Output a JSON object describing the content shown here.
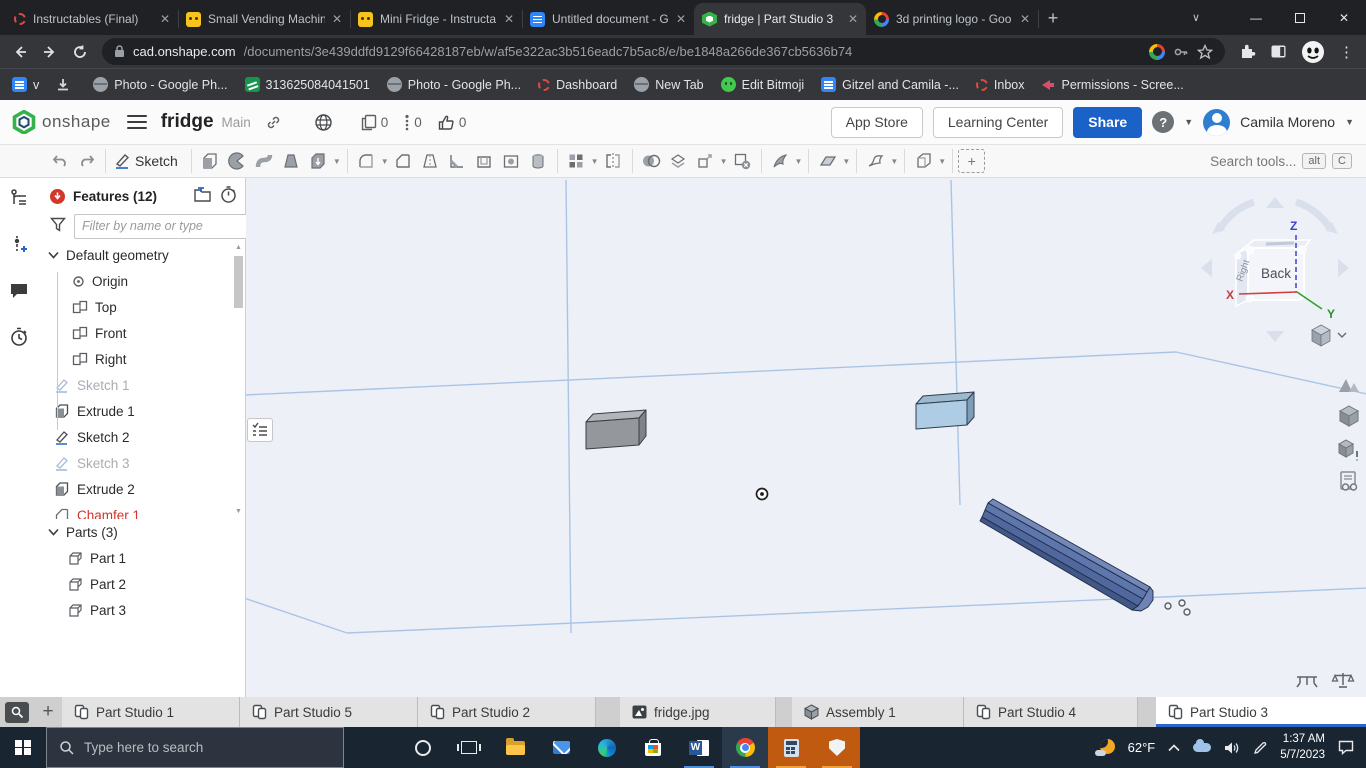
{
  "colors": {
    "accent_blue": "#1b62c8",
    "active_tab_underline": "#2a66c9",
    "error_red": "#d0342b",
    "viewport_bg": "#edf0f6",
    "plane_line": "#aac4e6",
    "part_gray": "#94989c",
    "part_blue_light": "#aecce3",
    "part_blue_bar": "#50689e",
    "taskbar_attention": "#c05a11"
  },
  "browser": {
    "tabs": [
      {
        "title": "Instructables (Final)"
      },
      {
        "title": "Small Vending Machin"
      },
      {
        "title": "Mini Fridge - Instructa"
      },
      {
        "title": "Untitled document - G"
      },
      {
        "title": "fridge | Part Studio 3"
      },
      {
        "title": "3d printing logo - Goo"
      }
    ],
    "nav": {
      "url_domain": "cad.onshape.com",
      "url_path": "/documents/3e439ddfd9129f66428187eb/w/af5e322ac3b516eadc7b5ac8/e/be1848a266de367cb5636b74"
    },
    "bookmarks": [
      {
        "label": "v"
      },
      {
        "label": ""
      },
      {
        "label": "Photo - Google Ph..."
      },
      {
        "label": "313625084041501"
      },
      {
        "label": "Photo - Google Ph..."
      },
      {
        "label": "Dashboard"
      },
      {
        "label": "New Tab"
      },
      {
        "label": "Edit Bitmoji"
      },
      {
        "label": "Gitzel and Camila -..."
      },
      {
        "label": "Inbox"
      },
      {
        "label": "Permissions - Scree..."
      }
    ]
  },
  "onshape": {
    "header": {
      "logo": "onshape",
      "title": "fridge",
      "workspace": "Main",
      "copy_count": "0",
      "version_count": "0",
      "like_count": "0",
      "app_store_label": "App Store",
      "learning_center_label": "Learning Center",
      "share_label": "Share",
      "help_label": "?",
      "user_name": "Camila Moreno"
    },
    "toolbar": {
      "sketch_label": "Sketch",
      "search_text": "Search tools...",
      "shortcut_alt": "alt",
      "shortcut_c": "C"
    },
    "features_panel": {
      "title": "Features (12)",
      "filter_placeholder": "Filter by name or type",
      "tree": [
        {
          "label": "Default geometry"
        },
        {
          "label": "Origin"
        },
        {
          "label": "Top"
        },
        {
          "label": "Front"
        },
        {
          "label": "Right"
        },
        {
          "label": "Sketch 1"
        },
        {
          "label": "Extrude 1"
        },
        {
          "label": "Sketch 2"
        },
        {
          "label": "Sketch 3"
        },
        {
          "label": "Extrude 2"
        },
        {
          "label": "Chamfer 1"
        }
      ],
      "parts_title": "Parts (3)",
      "parts": [
        {
          "label": "Part 1"
        },
        {
          "label": "Part 2"
        },
        {
          "label": "Part 3"
        }
      ]
    },
    "viewcube": {
      "front": "Back",
      "side": "Right",
      "axis_x": "X",
      "axis_y": "Y",
      "axis_z": "Z"
    },
    "doc_tabs": [
      {
        "label": "Part Studio 1"
      },
      {
        "label": "Part Studio 5"
      },
      {
        "label": "Part Studio 2"
      },
      {
        "label": "fridge.jpg"
      },
      {
        "label": "Assembly 1"
      },
      {
        "label": "Part Studio 4"
      },
      {
        "label": "Part Studio 3"
      }
    ]
  },
  "taskbar": {
    "search_placeholder": "Type here to search",
    "temperature": "62°F",
    "time": "1:37 AM",
    "date": "5/7/2023"
  }
}
